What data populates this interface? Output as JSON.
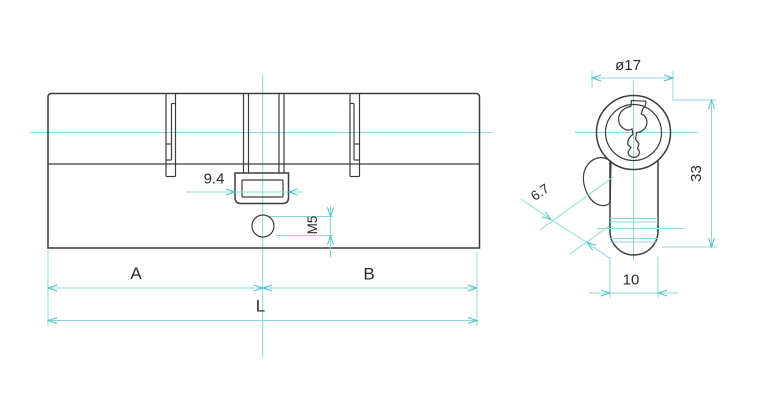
{
  "colors": {
    "outline": "#3c3c3c",
    "dimension": "#8ed8d8",
    "arrow": "#4fc1c4",
    "text": "#2b2b2b",
    "background": "#ffffff"
  },
  "side_view": {
    "description": "lock cylinder side elevation",
    "labels": {
      "cam_width": "9.4",
      "screw_thread": "M5",
      "segment_a": "A",
      "segment_b": "B",
      "total_length": "L"
    }
  },
  "end_view": {
    "description": "lock cylinder end profile",
    "labels": {
      "plug_diameter": "ø17",
      "cam_throw": "6.7",
      "body_height": "33",
      "body_width": "10"
    }
  }
}
